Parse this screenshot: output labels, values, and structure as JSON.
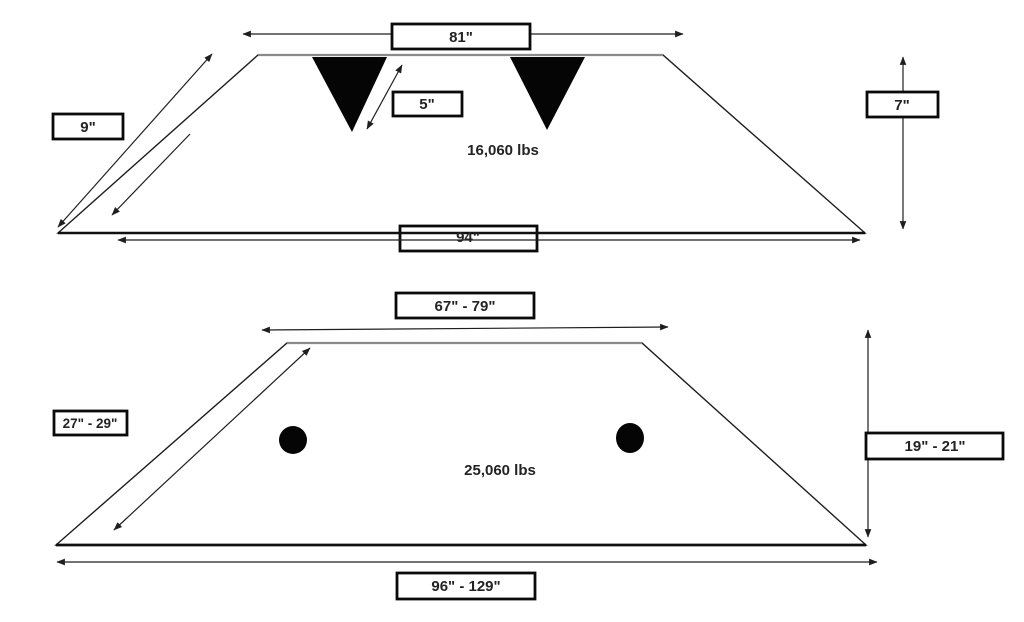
{
  "colors": {
    "background": "#ffffff",
    "line": "#1f1f1f",
    "top_edge_gray": "#8a8a8a",
    "solid_shape": "#050505",
    "box_border": "#0a0a0a",
    "box_fill": "#ffffff",
    "text": "#232323"
  },
  "diagrams": {
    "top": {
      "top_width": "81\"",
      "side_length": "9\"",
      "pocket_depth": "5\"",
      "weight": "16,060 lbs",
      "bottom_width": "94\"",
      "height": "7\""
    },
    "bottom": {
      "top_width": "67\" - 79\"",
      "side_length": "27\" - 29\"",
      "weight": "25,060 lbs",
      "height": "19\" - 21\"",
      "bottom_width": "96\" - 129\""
    }
  }
}
